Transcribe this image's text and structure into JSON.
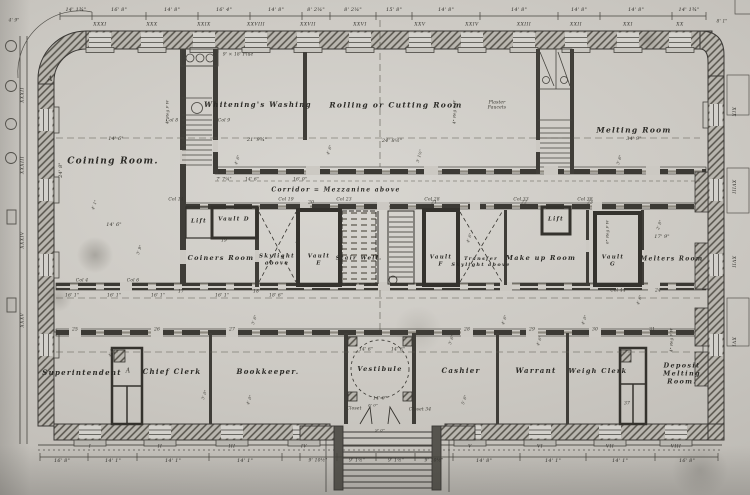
{
  "colors": {
    "paper": "#cdcac4",
    "ink": "#3a3835"
  },
  "rooms": [
    {
      "name": "coining-room",
      "text": "Coining Room.",
      "x": 113,
      "y": 162,
      "fs": 9
    },
    {
      "name": "whitenings-washing",
      "text": "Whitening's Washing",
      "x": 258,
      "y": 105,
      "fs": 7
    },
    {
      "name": "rolling-cutting-room",
      "text": "Rolling or Cutting Room",
      "x": 396,
      "y": 105,
      "fs": 7.5
    },
    {
      "name": "melting-room",
      "text": "Melting Room",
      "x": 634,
      "y": 130,
      "fs": 7.5
    },
    {
      "name": "corridor",
      "text": "Corridor = Mezzanine above",
      "x": 336,
      "y": 190,
      "fs": 6
    },
    {
      "name": "lift-1",
      "text": "Lift",
      "x": 199,
      "y": 222,
      "fs": 5.5
    },
    {
      "name": "vault-d",
      "text": "Vault D",
      "x": 234,
      "y": 220,
      "fs": 5.5
    },
    {
      "name": "coiners-room",
      "text": "Coiners Room",
      "x": 221,
      "y": 259,
      "fs": 6.5
    },
    {
      "name": "skylight-above",
      "text": "Skylight\nabove",
      "x": 277,
      "y": 260,
      "fs": 5.5
    },
    {
      "name": "vault-e",
      "text": "Vault\nE",
      "x": 319,
      "y": 260,
      "fs": 5.5
    },
    {
      "name": "stair-well",
      "text": "Stair Well.",
      "x": 359,
      "y": 259,
      "fs": 5.5
    },
    {
      "name": "vault-f",
      "text": "Vault\nF",
      "x": 441,
      "y": 261,
      "fs": 5.5
    },
    {
      "name": "transfer-skylight",
      "text": "Transfer\nSkylight above",
      "x": 481,
      "y": 262,
      "fs": 5
    },
    {
      "name": "make-up-room",
      "text": "Make up Room",
      "x": 541,
      "y": 259,
      "fs": 6.5
    },
    {
      "name": "lift-2",
      "text": "Lift",
      "x": 556,
      "y": 220,
      "fs": 5.5
    },
    {
      "name": "vault-g",
      "text": "Vault\nG",
      "x": 613,
      "y": 261,
      "fs": 5.5
    },
    {
      "name": "melters-room",
      "text": "Melters Room",
      "x": 672,
      "y": 259,
      "fs": 6
    },
    {
      "name": "superintendent",
      "text": "Superintendent",
      "x": 82,
      "y": 373,
      "fs": 7
    },
    {
      "name": "chief-clerk",
      "text": "Chief Clerk",
      "x": 172,
      "y": 372,
      "fs": 7
    },
    {
      "name": "bookkeeper",
      "text": "Bookkeeper.",
      "x": 268,
      "y": 372,
      "fs": 7
    },
    {
      "name": "vestibule",
      "text": "Vestibule",
      "x": 380,
      "y": 370,
      "fs": 6.5
    },
    {
      "name": "cashier",
      "text": "Cashier",
      "x": 461,
      "y": 371,
      "fs": 7
    },
    {
      "name": "warrant",
      "text": "Warrant",
      "x": 536,
      "y": 371,
      "fs": 7
    },
    {
      "name": "weigh-clerk",
      "text": "Weigh Clerk",
      "x": 598,
      "y": 372,
      "fs": 6.5
    },
    {
      "name": "deposit-melting-room",
      "text": "Deposit Melting\nRoom.",
      "x": 682,
      "y": 374,
      "fs": 6.5
    }
  ],
  "top_dims": [
    {
      "text": "14' 1¾\"",
      "x": 76,
      "y": 10,
      "fs": 5
    },
    {
      "text": "16' 8\"",
      "x": 119,
      "y": 10,
      "fs": 5
    },
    {
      "text": "14' 8\"",
      "x": 172,
      "y": 10,
      "fs": 5
    },
    {
      "text": "16' 4\"",
      "x": 224,
      "y": 10,
      "fs": 5
    },
    {
      "text": "14' 8\"",
      "x": 276,
      "y": 10,
      "fs": 5
    },
    {
      "text": "8' 2¼\"",
      "x": 316,
      "y": 10,
      "fs": 5
    },
    {
      "text": "8' 2¼\"",
      "x": 353,
      "y": 10,
      "fs": 5
    },
    {
      "text": "15' 8\"",
      "x": 394,
      "y": 10,
      "fs": 5
    },
    {
      "text": "14' 8\"",
      "x": 446,
      "y": 10,
      "fs": 5
    },
    {
      "text": "14' 8\"",
      "x": 519,
      "y": 10,
      "fs": 5
    },
    {
      "text": "14' 8\"",
      "x": 579,
      "y": 10,
      "fs": 5
    },
    {
      "text": "14' 8\"",
      "x": 636,
      "y": 10,
      "fs": 5
    },
    {
      "text": "14' 1¾\"",
      "x": 689,
      "y": 10,
      "fs": 5
    }
  ],
  "top_numerals": [
    {
      "text": "XXXI",
      "x": 100,
      "y": 25,
      "fs": 4.5
    },
    {
      "text": "XXX",
      "x": 152,
      "y": 25,
      "fs": 4.5
    },
    {
      "text": "XXIX",
      "x": 204,
      "y": 25,
      "fs": 4.5
    },
    {
      "text": "XXVIII",
      "x": 256,
      "y": 25,
      "fs": 4.5
    },
    {
      "text": "XXVII",
      "x": 308,
      "y": 25,
      "fs": 4.5
    },
    {
      "text": "XXVI",
      "x": 360,
      "y": 25,
      "fs": 4.5
    },
    {
      "text": "XXV",
      "x": 420,
      "y": 25,
      "fs": 4.5
    },
    {
      "text": "XXIV",
      "x": 472,
      "y": 25,
      "fs": 4.5
    },
    {
      "text": "XXIII",
      "x": 524,
      "y": 25,
      "fs": 4.5
    },
    {
      "text": "XXII",
      "x": 576,
      "y": 25,
      "fs": 4.5
    },
    {
      "text": "XXI",
      "x": 628,
      "y": 25,
      "fs": 4.5
    },
    {
      "text": "XX",
      "x": 680,
      "y": 25,
      "fs": 4.5
    }
  ],
  "bottom_numerals": [
    {
      "text": "I",
      "x": 90,
      "y": 447,
      "fs": 4.5
    },
    {
      "text": "II",
      "x": 160,
      "y": 447,
      "fs": 4.5
    },
    {
      "text": "III",
      "x": 232,
      "y": 447,
      "fs": 4.5
    },
    {
      "text": "IV",
      "x": 304,
      "y": 447,
      "fs": 4.5
    },
    {
      "text": "V",
      "x": 470,
      "y": 447,
      "fs": 4.5
    },
    {
      "text": "VI",
      "x": 540,
      "y": 447,
      "fs": 4.5
    },
    {
      "text": "VII",
      "x": 610,
      "y": 447,
      "fs": 4.5
    },
    {
      "text": "VIII",
      "x": 676,
      "y": 447,
      "fs": 4.5
    }
  ],
  "bottom_dims": [
    {
      "text": "16' 8\"",
      "x": 62,
      "y": 461,
      "fs": 5
    },
    {
      "text": "14' 1\"",
      "x": 113,
      "y": 461,
      "fs": 5
    },
    {
      "text": "14' 1\"",
      "x": 173,
      "y": 461,
      "fs": 5
    },
    {
      "text": "14' 1\"",
      "x": 245,
      "y": 461,
      "fs": 5
    },
    {
      "text": "9' 10½\"",
      "x": 318,
      "y": 461,
      "fs": 4.5
    },
    {
      "text": "9' 1½\"",
      "x": 357,
      "y": 461,
      "fs": 4.5
    },
    {
      "text": "9' 1½\"",
      "x": 396,
      "y": 461,
      "fs": 4.5
    },
    {
      "text": "9' 10½\"",
      "x": 434,
      "y": 461,
      "fs": 4.5
    },
    {
      "text": "14' 8\"",
      "x": 484,
      "y": 461,
      "fs": 5
    },
    {
      "text": "14' 1\"",
      "x": 553,
      "y": 461,
      "fs": 5
    },
    {
      "text": "14' 1\"",
      "x": 620,
      "y": 461,
      "fs": 5
    },
    {
      "text": "16' 8\"",
      "x": 687,
      "y": 461,
      "fs": 5
    }
  ],
  "left_numerals": [
    {
      "text": "XXXII",
      "x": 23,
      "y": 95,
      "fs": 4.5,
      "rot": -90
    },
    {
      "text": "XXXIII",
      "x": 23,
      "y": 165,
      "fs": 4.5,
      "rot": -90
    },
    {
      "text": "XXXIV",
      "x": 23,
      "y": 240,
      "fs": 4.5,
      "rot": -90
    },
    {
      "text": "XXXV",
      "x": 23,
      "y": 320,
      "fs": 4.5,
      "rot": -90
    }
  ],
  "right_numerals": [
    {
      "text": "XIX",
      "x": 733,
      "y": 112,
      "fs": 4.5,
      "rot": 90
    },
    {
      "text": "XVIII",
      "x": 733,
      "y": 187,
      "fs": 4.5,
      "rot": 90
    },
    {
      "text": "XVII",
      "x": 733,
      "y": 262,
      "fs": 4.5,
      "rot": 90
    },
    {
      "text": "XVI",
      "x": 733,
      "y": 342,
      "fs": 4.5,
      "rot": 90
    }
  ],
  "annotations": [
    {
      "text": "A",
      "x": 50,
      "y": 79,
      "fs": 7
    },
    {
      "text": "A",
      "x": 128,
      "y": 371,
      "fs": 6
    },
    {
      "text": "9' × 18' Flue",
      "x": 238,
      "y": 55,
      "fs": 4.5
    },
    {
      "text": "14' 6\"",
      "x": 116,
      "y": 139,
      "fs": 5
    },
    {
      "text": "14' 6\"",
      "x": 114,
      "y": 225,
      "fs": 5
    },
    {
      "text": "21' 9¾\"",
      "x": 257,
      "y": 140,
      "fs": 5
    },
    {
      "text": "24' 8½\"",
      "x": 392,
      "y": 141,
      "fs": 5
    },
    {
      "text": "34' 9\"",
      "x": 634,
      "y": 139,
      "fs": 5
    },
    {
      "text": "17' 9\"",
      "x": 662,
      "y": 237,
      "fs": 5
    },
    {
      "text": "24' 8\"",
      "x": 61,
      "y": 170,
      "fs": 5,
      "rot": -90
    },
    {
      "text": "7' 7¼\"",
      "x": 224,
      "y": 180,
      "fs": 4.5
    },
    {
      "text": "14' 6\"",
      "x": 252,
      "y": 180,
      "fs": 4.5
    },
    {
      "text": "16' 0\"",
      "x": 300,
      "y": 180,
      "fs": 4.5
    },
    {
      "text": "16' 1\"",
      "x": 72,
      "y": 296,
      "fs": 4.5
    },
    {
      "text": "16' 1\"",
      "x": 114,
      "y": 296,
      "fs": 4.5
    },
    {
      "text": "16' 1\"",
      "x": 158,
      "y": 296,
      "fs": 4.5
    },
    {
      "text": "16' 1\"",
      "x": 222,
      "y": 296,
      "fs": 4.5
    },
    {
      "text": "18' 6\"",
      "x": 276,
      "y": 296,
      "fs": 4.5
    },
    {
      "text": "Col 8",
      "x": 172,
      "y": 121,
      "fs": 4.5
    },
    {
      "text": "Col 9",
      "x": 224,
      "y": 121,
      "fs": 4.5
    },
    {
      "text": "Col 14",
      "x": 176,
      "y": 200,
      "fs": 4.5
    },
    {
      "text": "Col 19",
      "x": 286,
      "y": 200,
      "fs": 4.5
    },
    {
      "text": "Col 23",
      "x": 344,
      "y": 200,
      "fs": 4.5
    },
    {
      "text": "Col 28",
      "x": 432,
      "y": 200,
      "fs": 4.5
    },
    {
      "text": "Col 33",
      "x": 521,
      "y": 200,
      "fs": 4.5
    },
    {
      "text": "Col 38",
      "x": 585,
      "y": 200,
      "fs": 4.5
    },
    {
      "text": "Col 4",
      "x": 82,
      "y": 281,
      "fs": 4.5
    },
    {
      "text": "Col 6",
      "x": 133,
      "y": 281,
      "fs": 4.5
    },
    {
      "text": "Col 44",
      "x": 618,
      "y": 291,
      "fs": 4.5
    },
    {
      "text": "17",
      "x": 181,
      "y": 292,
      "fs": 4.5
    },
    {
      "text": "18",
      "x": 256,
      "y": 292,
      "fs": 4.5
    },
    {
      "text": "19",
      "x": 224,
      "y": 241,
      "fs": 4.5
    },
    {
      "text": "20",
      "x": 311,
      "y": 203,
      "fs": 4.5
    },
    {
      "text": "21",
      "x": 434,
      "y": 203,
      "fs": 4.5
    },
    {
      "text": "22",
      "x": 524,
      "y": 203,
      "fs": 4.5
    },
    {
      "text": "23",
      "x": 590,
      "y": 203,
      "fs": 4.5
    },
    {
      "text": "24",
      "x": 658,
      "y": 291,
      "fs": 4.5
    },
    {
      "text": "25",
      "x": 75,
      "y": 330,
      "fs": 4.5
    },
    {
      "text": "26",
      "x": 157,
      "y": 330,
      "fs": 4.5
    },
    {
      "text": "27",
      "x": 232,
      "y": 330,
      "fs": 4.5
    },
    {
      "text": "28",
      "x": 467,
      "y": 330,
      "fs": 4.5
    },
    {
      "text": "29",
      "x": 532,
      "y": 330,
      "fs": 4.5
    },
    {
      "text": "30",
      "x": 595,
      "y": 330,
      "fs": 4.5
    },
    {
      "text": "31",
      "x": 652,
      "y": 330,
      "fs": 4.5
    },
    {
      "text": "37",
      "x": 627,
      "y": 404,
      "fs": 4.5
    },
    {
      "text": "Closet",
      "x": 354,
      "y": 409,
      "fs": 4.5
    },
    {
      "text": "Closet 34",
      "x": 420,
      "y": 410,
      "fs": 4.5
    },
    {
      "text": "Plaster\nFaucets",
      "x": 497,
      "y": 106,
      "fs": 4.5
    },
    {
      "text": "14' 6\"",
      "x": 366,
      "y": 350,
      "fs": 4.5
    },
    {
      "text": "14' 6\"",
      "x": 398,
      "y": 350,
      "fs": 4.5
    },
    {
      "text": "14' 0\"",
      "x": 380,
      "y": 399,
      "fs": 4.5
    },
    {
      "text": "6' 0\"",
      "x": 373,
      "y": 406,
      "fs": 4
    },
    {
      "text": "9' 0\"",
      "x": 380,
      "y": 431,
      "fs": 4
    },
    {
      "text": "4' 9\"",
      "x": 14,
      "y": 21,
      "fs": 4.5
    },
    {
      "text": "8' 1\"",
      "x": 722,
      "y": 22,
      "fs": 4.5
    },
    {
      "text": "4\" Reg F W",
      "x": 168,
      "y": 112,
      "fs": 4,
      "rot": -90
    },
    {
      "text": "4\" Reg F W",
      "x": 298,
      "y": 232,
      "fs": 4,
      "rot": -90
    },
    {
      "text": "4\" Reg F W",
      "x": 455,
      "y": 112,
      "fs": 4,
      "rot": -90
    },
    {
      "text": "6\" Reg F W",
      "x": 608,
      "y": 232,
      "fs": 4,
      "rot": -90
    },
    {
      "text": "4\" Reg F W",
      "x": 672,
      "y": 340,
      "fs": 4,
      "rot": -90
    },
    {
      "text": "4' 6\"",
      "x": 238,
      "y": 160,
      "fs": 4,
      "rot": -70
    },
    {
      "text": "3' 1½\"",
      "x": 420,
      "y": 156,
      "fs": 4,
      "rot": -75
    },
    {
      "text": "4' 6\"",
      "x": 470,
      "y": 238,
      "fs": 4,
      "rot": -70
    },
    {
      "text": "3' 6\"",
      "x": 620,
      "y": 160,
      "fs": 4,
      "rot": -72
    },
    {
      "text": "4' 0\"",
      "x": 112,
      "y": 352,
      "fs": 4,
      "rot": -70
    },
    {
      "text": "3' 6\"",
      "x": 452,
      "y": 340,
      "fs": 4,
      "rot": -70
    },
    {
      "text": "4' 6\"",
      "x": 540,
      "y": 341,
      "fs": 4,
      "rot": -70
    },
    {
      "text": "2' 8\"",
      "x": 660,
      "y": 225,
      "fs": 4,
      "rot": -70
    },
    {
      "text": "4' 1\"",
      "x": 95,
      "y": 205,
      "fs": 4,
      "rot": -70
    },
    {
      "text": "3' 9\"",
      "x": 140,
      "y": 250,
      "fs": 4,
      "rot": -70
    },
    {
      "text": "4' 6\"",
      "x": 330,
      "y": 150,
      "fs": 4,
      "rot": -70
    },
    {
      "text": "4' 6\"",
      "x": 505,
      "y": 320,
      "fs": 4,
      "rot": -70
    },
    {
      "text": "3' 6\"",
      "x": 255,
      "y": 320,
      "fs": 4,
      "rot": -70
    },
    {
      "text": "4' 0\"",
      "x": 585,
      "y": 320,
      "fs": 4,
      "rot": -70
    },
    {
      "text": "3' 0\"",
      "x": 205,
      "y": 395,
      "fs": 4,
      "rot": -70
    },
    {
      "text": "4' 0\"",
      "x": 250,
      "y": 400,
      "fs": 4,
      "rot": -70
    },
    {
      "text": "5' 6\"",
      "x": 465,
      "y": 400,
      "fs": 4,
      "rot": -70
    },
    {
      "text": "4' 6\"",
      "x": 640,
      "y": 300,
      "fs": 4,
      "rot": -70
    }
  ]
}
